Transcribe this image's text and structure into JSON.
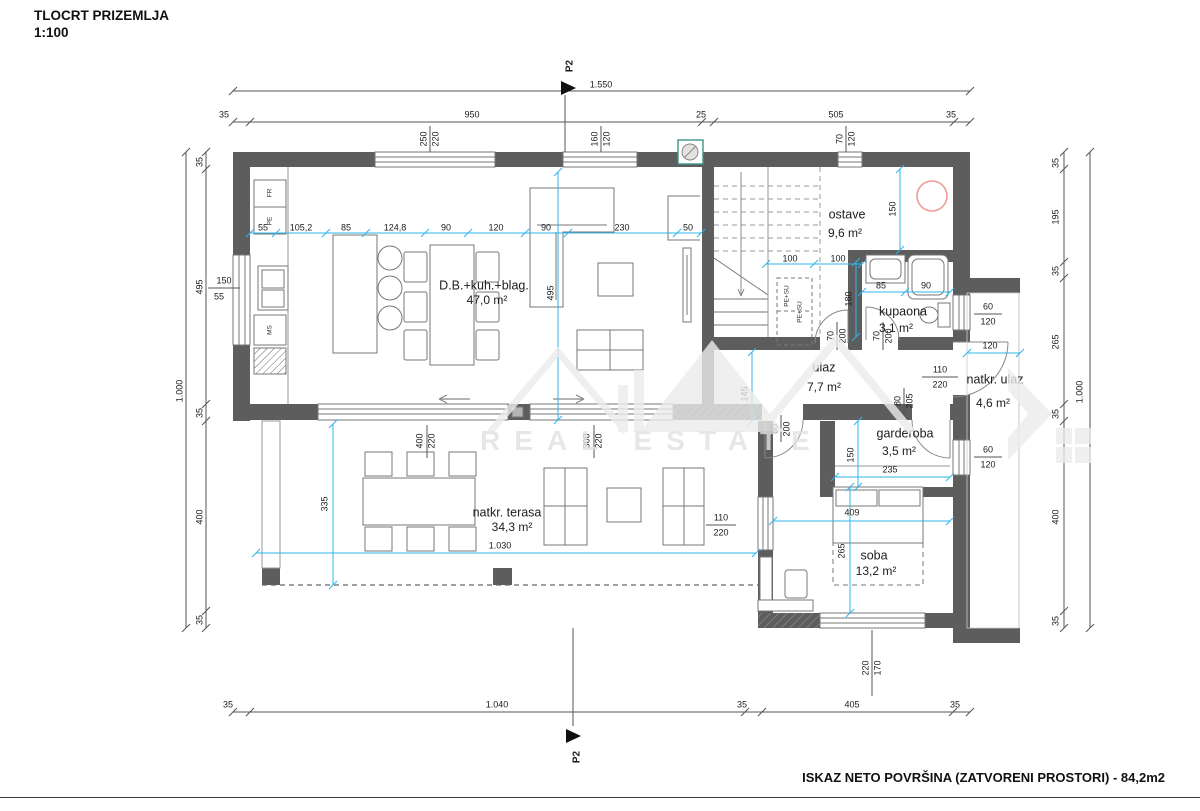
{
  "title": {
    "name": "TLOCRT PRIZEMLJA",
    "scale": "1:100"
  },
  "footer": {
    "summary": "ISKAZ NETO POVRŠINA (ZATVORENI PROSTORI) - 84,2m2"
  },
  "watermark": {
    "text": "REAL ESTATE"
  },
  "section_markers": [
    {
      "label": "P2",
      "x": 570,
      "y": 66
    },
    {
      "label": "P2",
      "x": 577,
      "y": 757
    }
  ],
  "rooms": [
    {
      "name": "D.B.+kuh.+blag.",
      "x": 484,
      "y": 286,
      "area": "47,0 m²",
      "ax": 487,
      "ay": 301
    },
    {
      "name": "ostave",
      "x": 847,
      "y": 215,
      "area": "9,6 m²",
      "ax": 845,
      "ay": 234
    },
    {
      "name": "kupaona",
      "x": 903,
      "y": 312,
      "area": "3,1 m²",
      "ax": 896,
      "ay": 329
    },
    {
      "name": "ulaz",
      "x": 824,
      "y": 368,
      "area": "7,7 m²",
      "ax": 824,
      "ay": 388
    },
    {
      "name": "natkr. ulaz",
      "x": 995,
      "y": 380,
      "area": "4,6 m²",
      "ax": 993,
      "ay": 404
    },
    {
      "name": "garderoba",
      "x": 905,
      "y": 434,
      "area": "3,5 m²",
      "ax": 899,
      "ay": 452
    },
    {
      "name": "soba",
      "x": 874,
      "y": 556,
      "area": "13,2 m²",
      "ax": 876,
      "ay": 572
    },
    {
      "name": "natkr. terasa",
      "x": 507,
      "y": 513,
      "area": "34,3 m²",
      "ax": 512,
      "ay": 528
    }
  ],
  "appliances": [
    {
      "t": "FR",
      "x": 270,
      "y": 193
    },
    {
      "t": "PE",
      "x": 270,
      "y": 221
    },
    {
      "t": "MS",
      "x": 270,
      "y": 330
    },
    {
      "t": "PE+SU",
      "x": 787,
      "y": 296
    },
    {
      "t": "PE+SU",
      "x": 800,
      "y": 312
    }
  ],
  "dim_labels": [
    {
      "t": "1.550",
      "x": 601,
      "y": 85
    },
    {
      "t": "35",
      "x": 224,
      "y": 115
    },
    {
      "t": "950",
      "x": 472,
      "y": 115
    },
    {
      "t": "25",
      "x": 701,
      "y": 115
    },
    {
      "t": "505",
      "x": 836,
      "y": 115
    },
    {
      "t": "35",
      "x": 951,
      "y": 115
    },
    {
      "t": "250",
      "x": 424,
      "y": 139,
      "r": -90
    },
    {
      "t": "220",
      "x": 436,
      "y": 139,
      "r": -90
    },
    {
      "t": "160",
      "x": 595,
      "y": 139,
      "r": -90
    },
    {
      "t": "120",
      "x": 607,
      "y": 139,
      "r": -90
    },
    {
      "t": "70",
      "x": 840,
      "y": 139,
      "r": -90
    },
    {
      "t": "120",
      "x": 852,
      "y": 139,
      "r": -90
    },
    {
      "t": "35",
      "x": 200,
      "y": 162,
      "r": -90
    },
    {
      "t": "495",
      "x": 200,
      "y": 287,
      "r": -90
    },
    {
      "t": "35",
      "x": 200,
      "y": 413,
      "r": -90
    },
    {
      "t": "400",
      "x": 200,
      "y": 517,
      "r": -90
    },
    {
      "t": "35",
      "x": 200,
      "y": 620,
      "r": -90
    },
    {
      "t": "1.000",
      "x": 180,
      "y": 391,
      "r": -90
    },
    {
      "t": "150",
      "x": 224,
      "y": 281
    },
    {
      "t": "55",
      "x": 219,
      "y": 297
    },
    {
      "t": "35",
      "x": 1056,
      "y": 163,
      "r": -90
    },
    {
      "t": "195",
      "x": 1056,
      "y": 217,
      "r": -90
    },
    {
      "t": "35",
      "x": 1056,
      "y": 271,
      "r": -90
    },
    {
      "t": "265",
      "x": 1056,
      "y": 342,
      "r": -90
    },
    {
      "t": "35",
      "x": 1056,
      "y": 414,
      "r": -90
    },
    {
      "t": "400",
      "x": 1056,
      "y": 517,
      "r": -90
    },
    {
      "t": "35",
      "x": 1056,
      "y": 621,
      "r": -90
    },
    {
      "t": "1.000",
      "x": 1080,
      "y": 392,
      "r": -90
    },
    {
      "t": "35",
      "x": 228,
      "y": 705
    },
    {
      "t": "1.040",
      "x": 497,
      "y": 705
    },
    {
      "t": "35",
      "x": 742,
      "y": 705
    },
    {
      "t": "405",
      "x": 852,
      "y": 705
    },
    {
      "t": "35",
      "x": 955,
      "y": 705
    },
    {
      "t": "55",
      "x": 263,
      "y": 228
    },
    {
      "t": "105,2",
      "x": 301,
      "y": 228
    },
    {
      "t": "85",
      "x": 346,
      "y": 228
    },
    {
      "t": "124,8",
      "x": 395,
      "y": 228
    },
    {
      "t": "90",
      "x": 446,
      "y": 228
    },
    {
      "t": "120",
      "x": 496,
      "y": 228
    },
    {
      "t": "90",
      "x": 546,
      "y": 228
    },
    {
      "t": "230",
      "x": 622,
      "y": 228
    },
    {
      "t": "50",
      "x": 688,
      "y": 228
    },
    {
      "t": "495",
      "x": 551,
      "y": 293,
      "r": -90
    },
    {
      "t": "100",
      "x": 790,
      "y": 259
    },
    {
      "t": "100",
      "x": 838,
      "y": 259
    },
    {
      "t": "150",
      "x": 893,
      "y": 209,
      "r": -90
    },
    {
      "t": "85",
      "x": 881,
      "y": 286
    },
    {
      "t": "90",
      "x": 926,
      "y": 286
    },
    {
      "t": "180",
      "x": 849,
      "y": 299,
      "r": -90
    },
    {
      "t": "70",
      "x": 831,
      "y": 336,
      "r": -90
    },
    {
      "t": "200",
      "x": 843,
      "y": 336,
      "r": -90
    },
    {
      "t": "70",
      "x": 877,
      "y": 336,
      "r": -90
    },
    {
      "t": "200",
      "x": 889,
      "y": 336,
      "r": -90
    },
    {
      "t": "80",
      "x": 775,
      "y": 429,
      "r": -90
    },
    {
      "t": "200",
      "x": 787,
      "y": 429,
      "r": -90
    },
    {
      "t": "80",
      "x": 898,
      "y": 401,
      "r": -90
    },
    {
      "t": "205",
      "x": 910,
      "y": 401,
      "r": -90
    },
    {
      "t": "110",
      "x": 940,
      "y": 370
    },
    {
      "t": "220",
      "x": 940,
      "y": 385
    },
    {
      "t": "120",
      "x": 990,
      "y": 346
    },
    {
      "t": "145",
      "x": 745,
      "y": 394,
      "r": -90
    },
    {
      "t": "60",
      "x": 988,
      "y": 307
    },
    {
      "t": "120",
      "x": 988,
      "y": 322
    },
    {
      "t": "60",
      "x": 988,
      "y": 450
    },
    {
      "t": "120",
      "x": 988,
      "y": 465
    },
    {
      "t": "150",
      "x": 851,
      "y": 455,
      "r": -90
    },
    {
      "t": "235",
      "x": 890,
      "y": 470
    },
    {
      "t": "409",
      "x": 852,
      "y": 513
    },
    {
      "t": "265",
      "x": 842,
      "y": 551,
      "r": -90
    },
    {
      "t": "110",
      "x": 721,
      "y": 518
    },
    {
      "t": "220",
      "x": 721,
      "y": 533
    },
    {
      "t": "220",
      "x": 866,
      "y": 668,
      "r": -90
    },
    {
      "t": "170",
      "x": 878,
      "y": 668,
      "r": -90
    },
    {
      "t": "400",
      "x": 420,
      "y": 441,
      "r": -90
    },
    {
      "t": "220",
      "x": 432,
      "y": 441,
      "r": -90
    },
    {
      "t": "300",
      "x": 587,
      "y": 441,
      "r": -90
    },
    {
      "t": "220",
      "x": 599,
      "y": 441,
      "r": -90
    },
    {
      "t": "1.030",
      "x": 500,
      "y": 546
    },
    {
      "t": "335",
      "x": 325,
      "y": 504,
      "r": -90
    }
  ]
}
